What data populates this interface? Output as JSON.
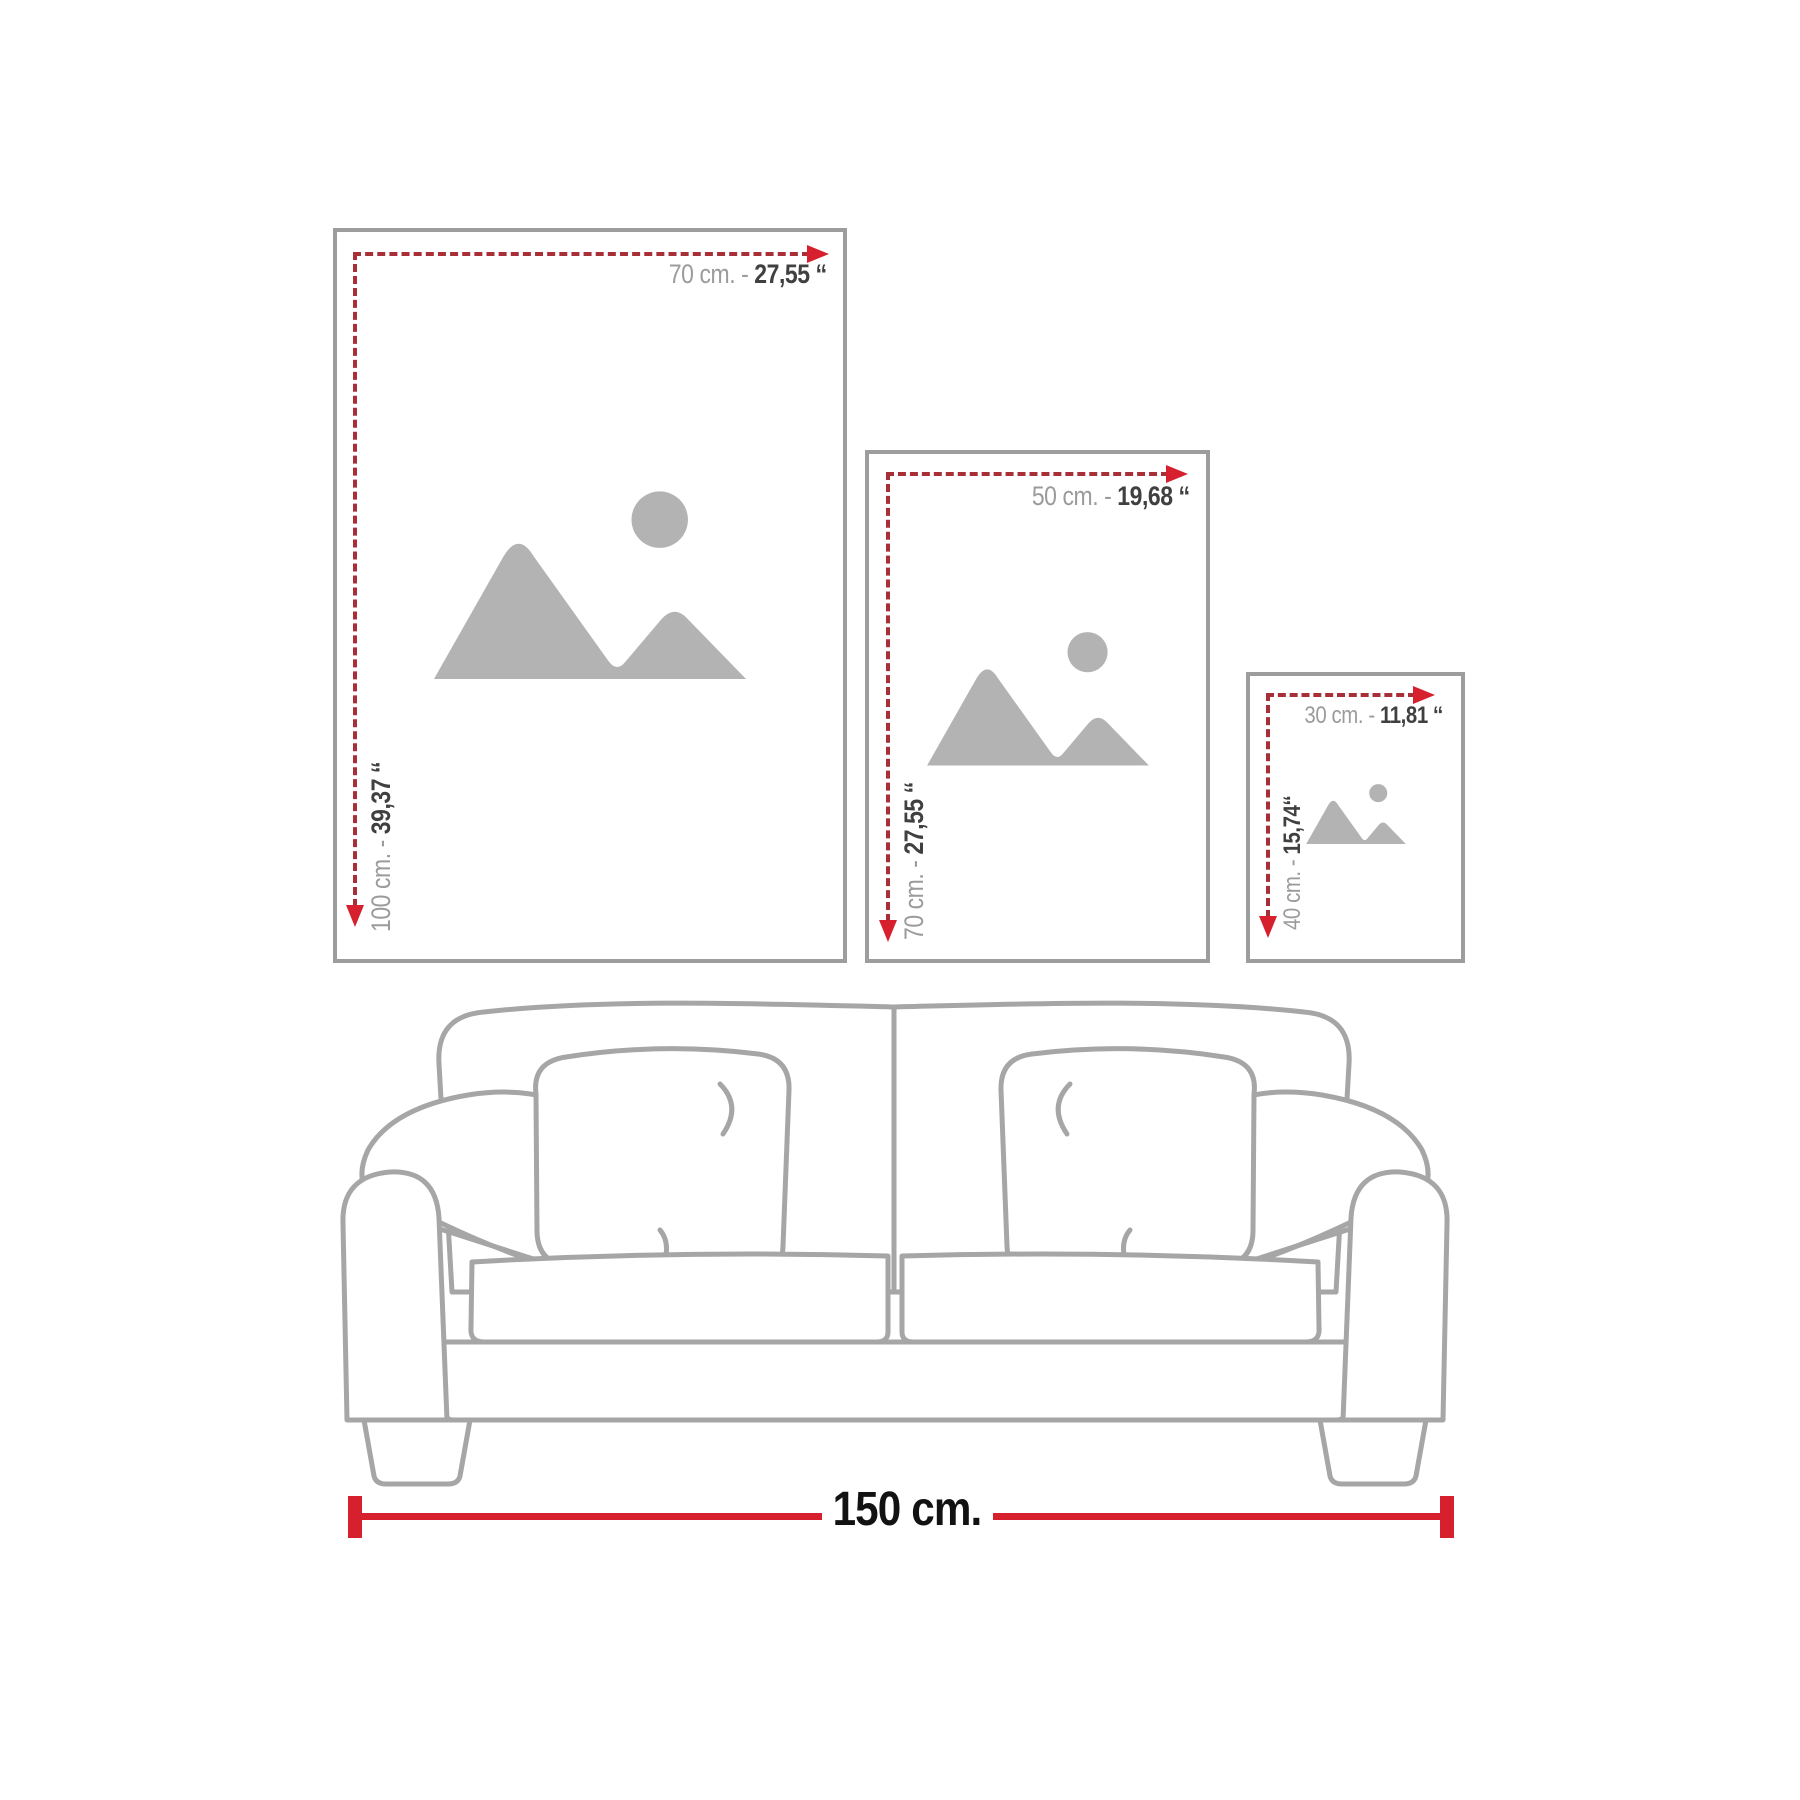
{
  "diagram_title": "wall-art-size-guide",
  "colors": {
    "frame_border": "#9d9d9d",
    "placeholder_gray": "#b3b3b3",
    "dash_red": "#a82f38",
    "arrow_red": "#d7202e",
    "solid_red": "#d7202e",
    "label_gray": "#9b9b9b",
    "label_dark": "#404040",
    "sofa_line": "#a6a6a6"
  },
  "frames": [
    {
      "name": "large",
      "width_cm": "70 cm. -",
      "width_in": "27,55 ‘‘",
      "height_cm": "100 cm. -",
      "height_in": "39,37 ‘‘"
    },
    {
      "name": "medium",
      "width_cm": "50 cm. -",
      "width_in": "19,68 ‘‘",
      "height_cm": "70 cm. -",
      "height_in": "27,55 ‘‘"
    },
    {
      "name": "small",
      "width_cm": "30 cm. -",
      "width_in": "11,81 ‘‘",
      "height_cm": "40 cm. -",
      "height_in": "15,74‘‘"
    }
  ],
  "sofa": {
    "width_label": "150 cm."
  },
  "icons": {
    "placeholder": "mountains-sun-image-placeholder"
  }
}
